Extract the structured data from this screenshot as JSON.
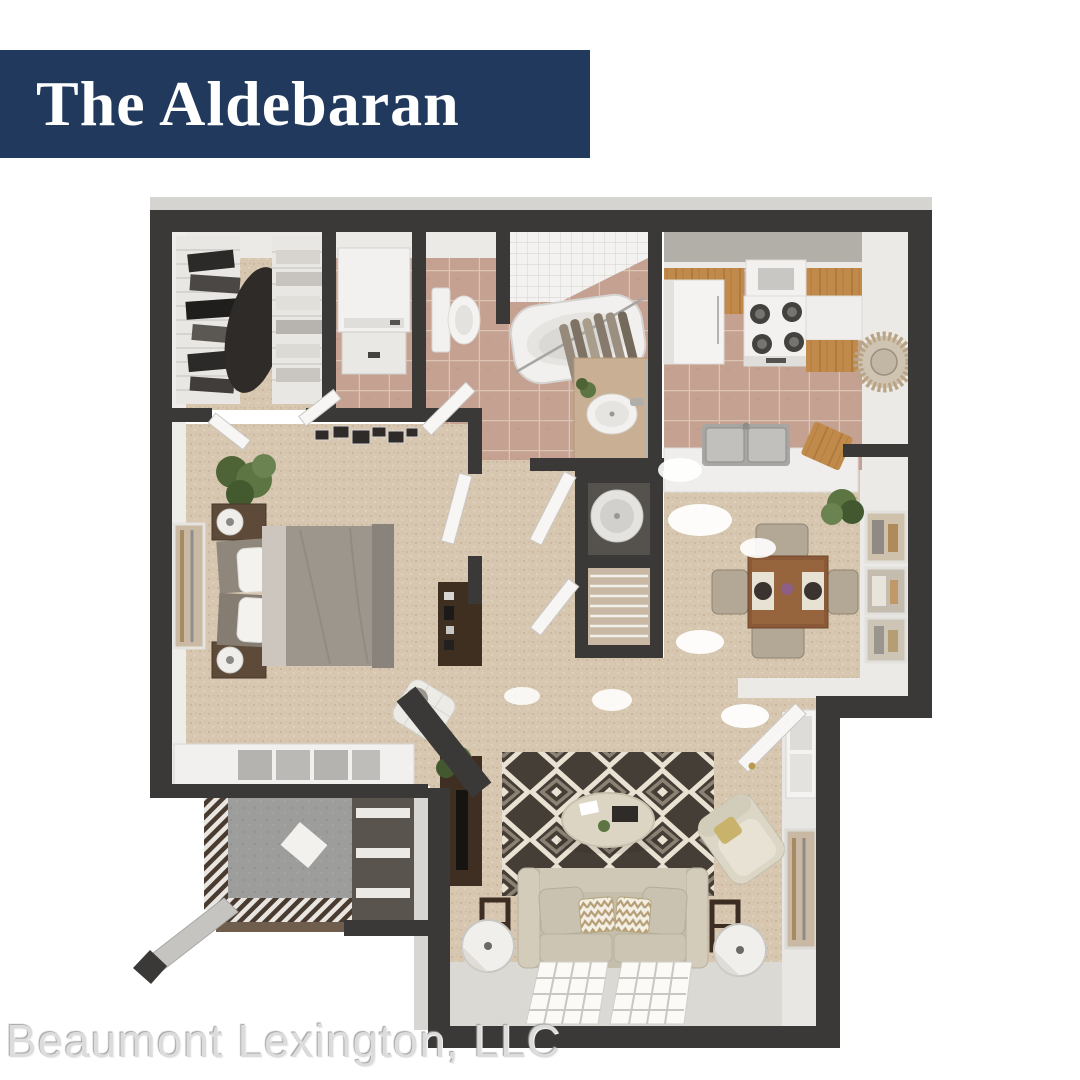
{
  "banner": {
    "title": "The Aldebaran",
    "background_color": "#21395c",
    "text_color": "#ffffff"
  },
  "watermark": {
    "text": "Beaumont Lexington, LLC",
    "color": "#dcdcdc"
  },
  "floor_plan": {
    "type": "3d-rendered-apartment-floor-plan",
    "wall_color": "#3b3937",
    "carpet_color": "#d7c7b0",
    "tile_color": "#c5a191",
    "wood_cabinet_color": "#c08a4a",
    "rug_colors": [
      "#453e37",
      "#e9e1d1"
    ],
    "patio_concrete_color": "#9d9d9b",
    "rooms": [
      "walk-in-closet",
      "laundry-closet",
      "toilet-room",
      "bathroom",
      "kitchen",
      "bedroom",
      "hallway",
      "water-heater-closet",
      "linen-closet",
      "dining-area",
      "living-room",
      "entry",
      "patio",
      "storage-closet"
    ]
  }
}
